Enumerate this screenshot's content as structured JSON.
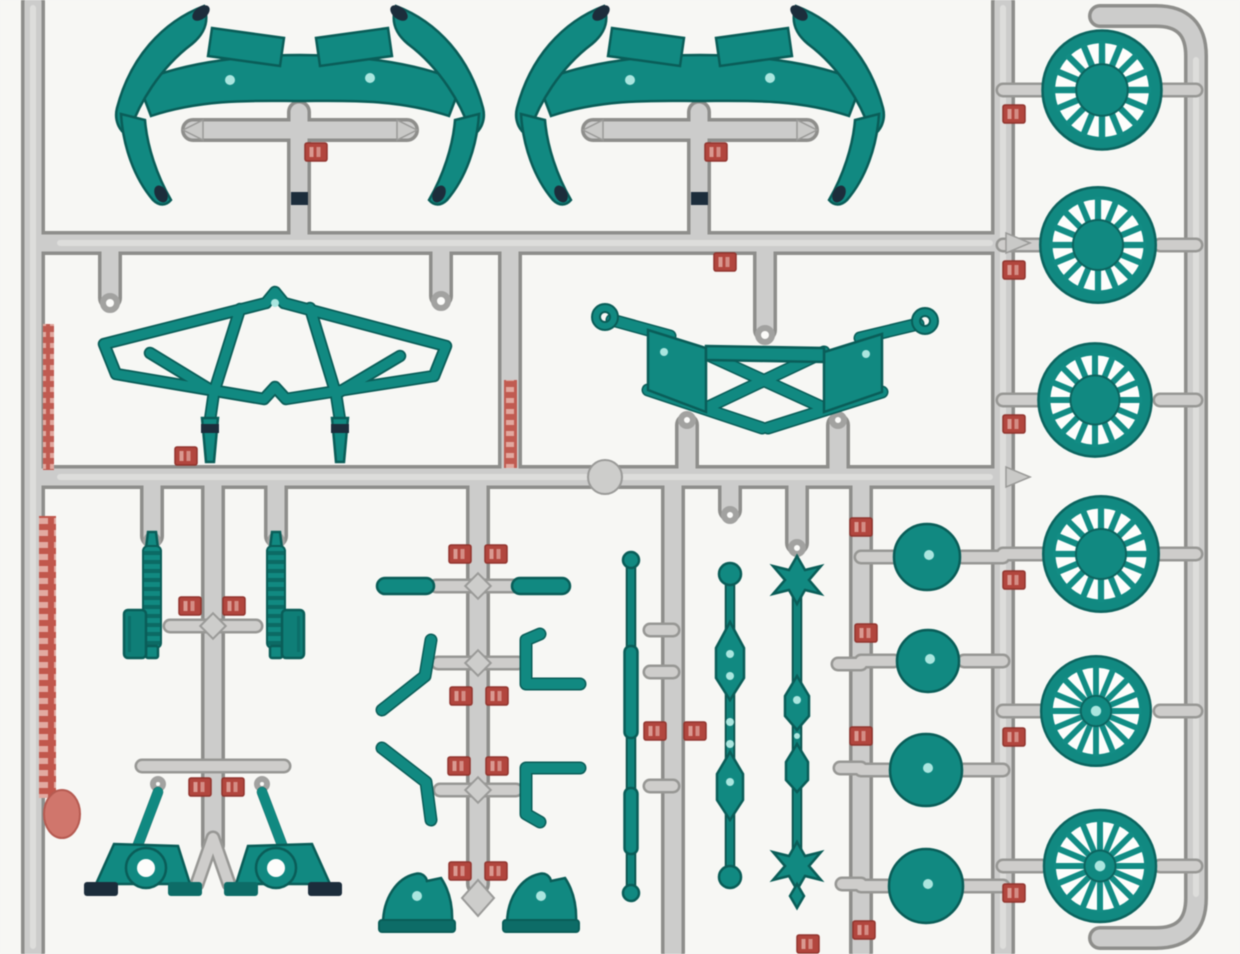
{
  "scene": {
    "kind": "plastic model kit parts sprue photo",
    "background_color": "#f7f7f4",
    "colors": {
      "part_teal": "#0e8a82",
      "part_teal_dark": "#085e58",
      "part_tip_navy": "#1c2d3c",
      "runner_gray": "#cccccb",
      "runner_edge": "#8e8e8b",
      "tag_red": "#b5453d",
      "tag_mark_light": "#dc9a90",
      "highlight_dot": "#a9e6df"
    }
  },
  "parts": {
    "sprue": {
      "label": "gray sprue runner frame"
    },
    "bumper": {
      "label": "bumper guard part",
      "count": 2
    },
    "truss": {
      "label": "front suspension truss part",
      "count": 1
    },
    "subframe": {
      "label": "rear subframe part with ring joints",
      "count": 1
    },
    "spring": {
      "label": "coil spring strut part",
      "count": 2
    },
    "shock": {
      "label": "angled shock absorber with eye ring",
      "count": 2
    },
    "tie_bar": {
      "label": "short tie bar part",
      "count": 2
    },
    "link_rod": {
      "label": "bent link rod part",
      "count": 2
    },
    "bracket": {
      "label": "L-shaped bracket part",
      "count": 2
    },
    "axle_mount": {
      "label": "axle mount dome part",
      "count": 2
    },
    "rod": {
      "label": "thin steering rod part",
      "count": 1
    },
    "driveshaft": {
      "label": "drive shaft with universal joints",
      "count": 2
    },
    "drum": {
      "label": "brake drum hub part",
      "count": 4
    },
    "wheel": {
      "label": "16-spoke wheel part",
      "count": 6,
      "spokes": 16
    }
  },
  "markings": {
    "left_rail_print": "vertical red print on left rail (illegible)",
    "runner_print": "vertical red print on center runner (illegible)",
    "part_tag": "red part-number stamp (illegible)",
    "part_tag_count": 29
  }
}
